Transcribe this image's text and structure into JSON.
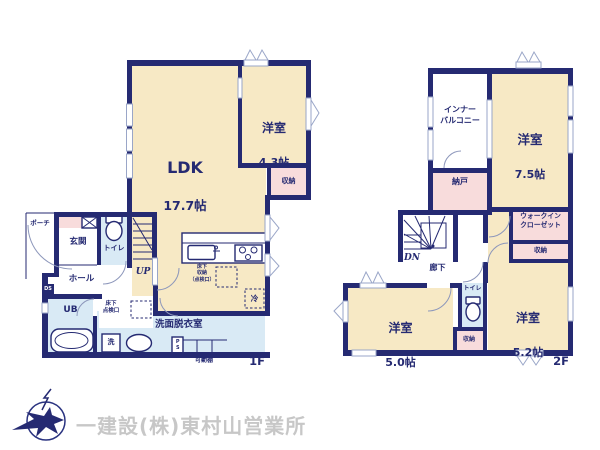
{
  "floor1": {
    "label": "1F",
    "ldk": {
      "name": "LDK",
      "size": "17.7帖"
    },
    "bedroom43": {
      "name": "洋室",
      "size": "4.3帖"
    },
    "closet": "収納",
    "porch": "ポーチ",
    "entrance": "玄関",
    "toilet": "トイレ",
    "hall": "ホール",
    "stairs_up": "UP",
    "duct_space": "DS",
    "unit_bath": "UB",
    "underfloor_access": "床下\n点検口",
    "washroom": "洗面脱衣室",
    "washer": "洗",
    "pipe_space": "PS",
    "movable_shelf": "可動棚",
    "underfloor_storage": "床下\n収納\n（点検口）",
    "fridge": "冷"
  },
  "floor2": {
    "label": "2F",
    "inner_balcony": "インナー\nバルコニー",
    "bedroom75": {
      "name": "洋室",
      "size": "7.5帖"
    },
    "storeroom": "納戸",
    "walk_in_closet": "ウォークイン\nクローゼット",
    "closet_upper": "収納",
    "bedroom52": {
      "name": "洋室",
      "size": "5.2帖"
    },
    "stairs_down": "DN",
    "corridor": "廊下",
    "toilet": "トイレ",
    "closet_lower": "収納",
    "bedroom50": {
      "name": "洋室",
      "size": "5.0帖"
    }
  },
  "footer": {
    "company": "一建設(株)東村山営業所"
  },
  "colors": {
    "wall": "#252a72",
    "room_cream": "#f7e9c5",
    "closet_pink": "#f8dcdc",
    "wet_blue": "#d9eaf5",
    "text_navy": "#252a72",
    "footer_gray": "#c7c7c7"
  }
}
